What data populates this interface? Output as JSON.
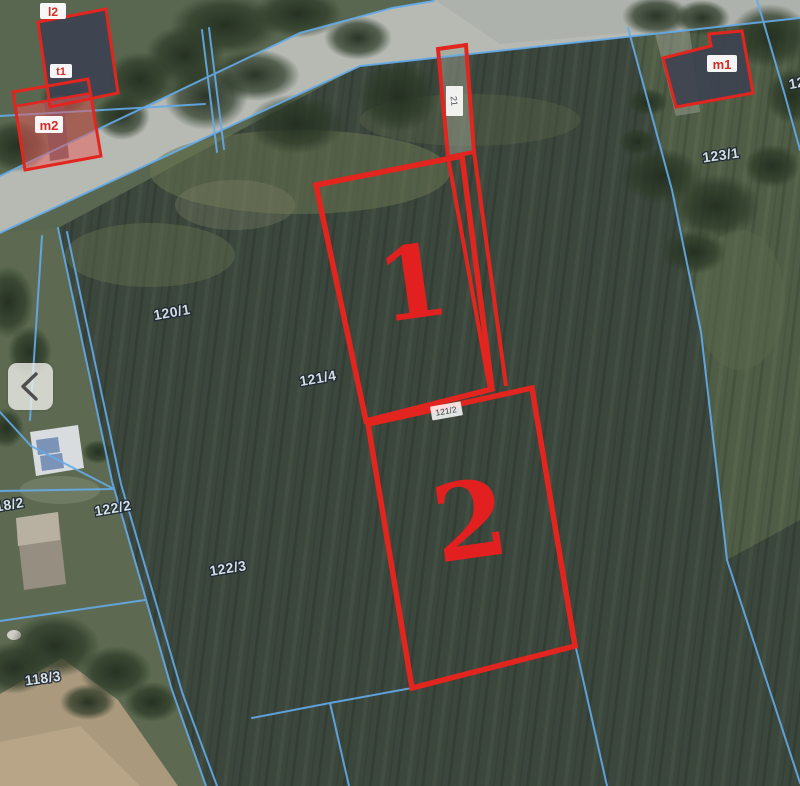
{
  "map": {
    "colors": {
      "highlight": "#e2251f",
      "boundary": "#64abea"
    },
    "plot_numbers": {
      "one": "1",
      "two": "2"
    },
    "cadastral_labels": {
      "p120_1": "120/1",
      "p121_4": "121/4",
      "p118_2": "118/2",
      "p122_2": "122/2",
      "p122_3": "122/3",
      "p118_3": "118/3",
      "p123_1": "123/1",
      "p123_edge": "123",
      "p121_2": "121/2",
      "p21": "21"
    },
    "building_labels": {
      "l2": "l2",
      "t1": "t1",
      "m2": "m2",
      "m1": "m1"
    }
  },
  "gallery": {
    "prev_icon": "chevron-left"
  }
}
